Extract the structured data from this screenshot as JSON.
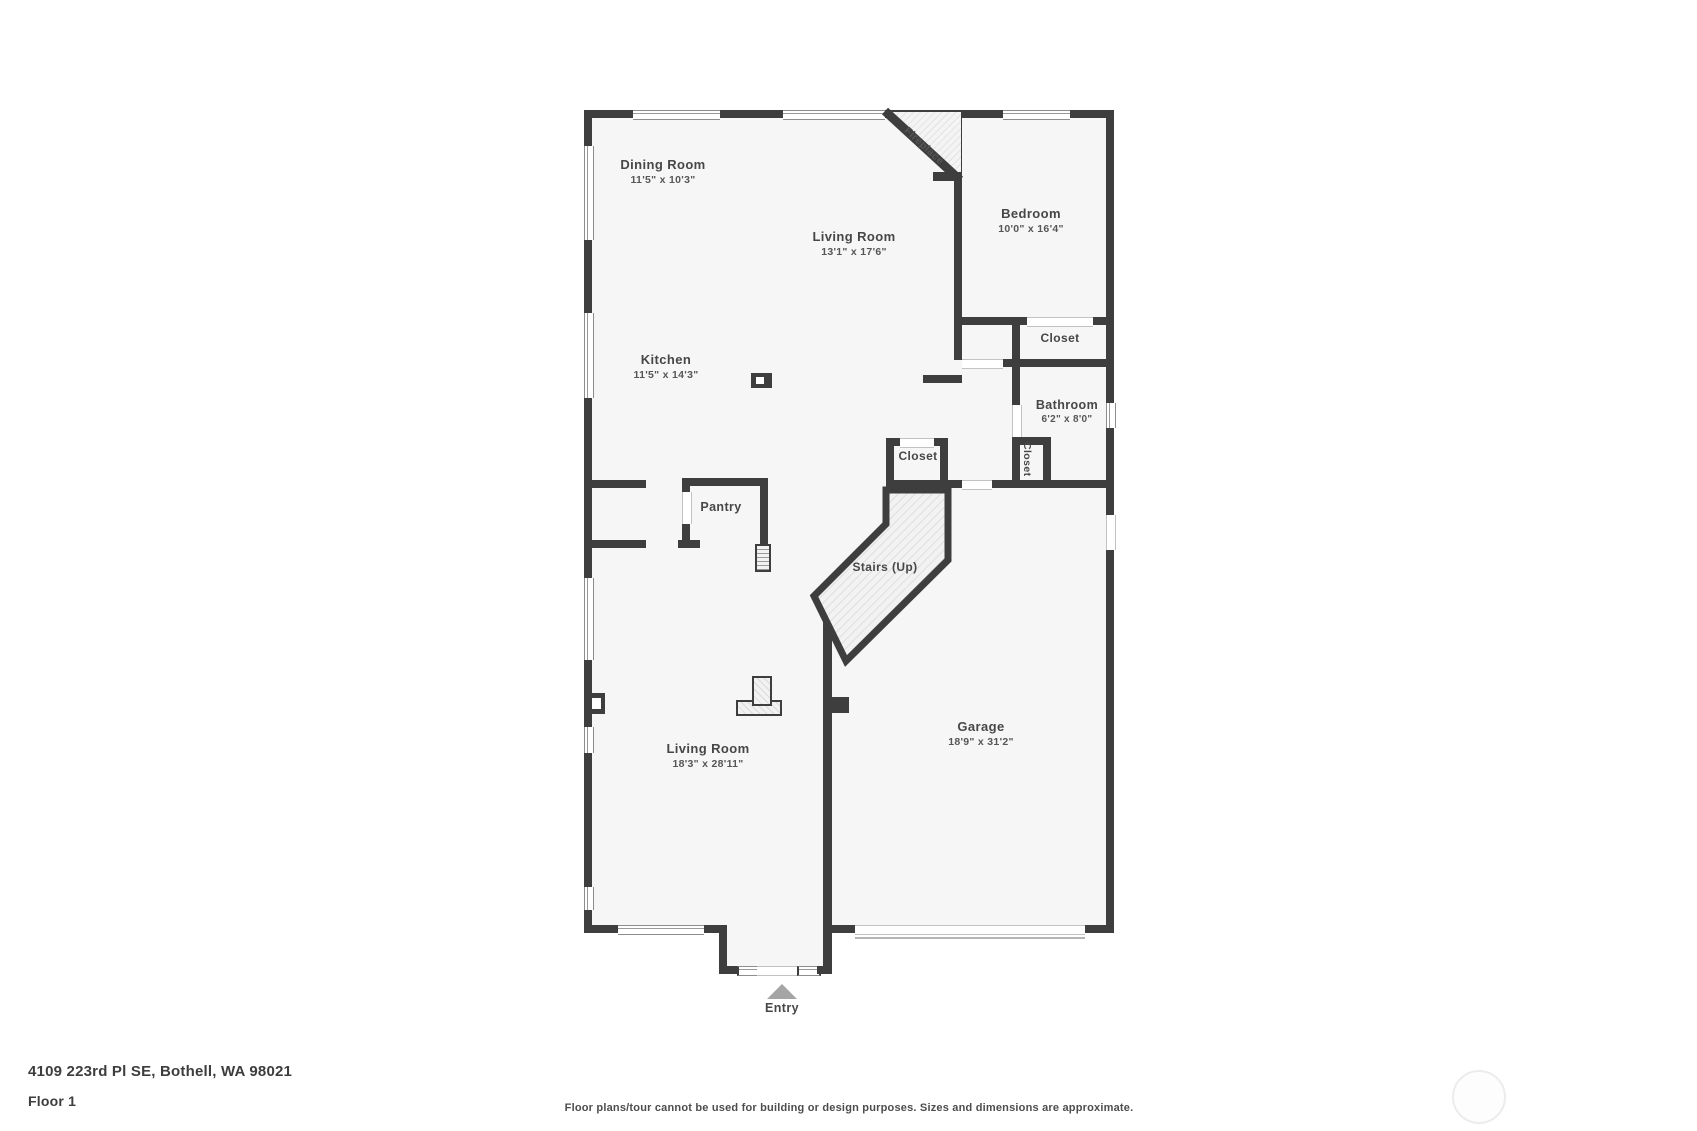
{
  "page": {
    "background": "#ffffff",
    "wall_color": "#3e3e3e",
    "floor_color": "#f6f6f6",
    "entry_arrow_color": "#a5a5a5"
  },
  "floor_plan": {
    "rooms": [
      {
        "name": "Dining Room",
        "dims": "11'5\" x 10'3\""
      },
      {
        "name": "Living Room",
        "dims": "13'1\" x 17'6\""
      },
      {
        "name": "Kitchen",
        "dims": "11'5\" x 14'3\""
      },
      {
        "name": "Bedroom",
        "dims": "10'0\" x 16'4\""
      },
      {
        "name": "Bathroom",
        "dims": "6'2\" x 8'0\""
      },
      {
        "name": "Living Room",
        "dims": "18'3\" x 28'11\""
      },
      {
        "name": "Garage",
        "dims": "18'9\" x 31'2\""
      }
    ],
    "labels": {
      "fireplace": "Fireplace",
      "closet_bedroom": "Closet",
      "closet_bathroom": "Closet",
      "closet_stairs": "Closet",
      "pantry": "Pantry",
      "stairs": "Stairs (Up)",
      "entry": "Entry"
    }
  },
  "footer": {
    "address": "4109 223rd Pl SE, Bothell, WA 98021",
    "floor": "Floor 1",
    "disclaimer": "Floor plans/tour cannot be used for building or design purposes. Sizes and dimensions are approximate."
  }
}
